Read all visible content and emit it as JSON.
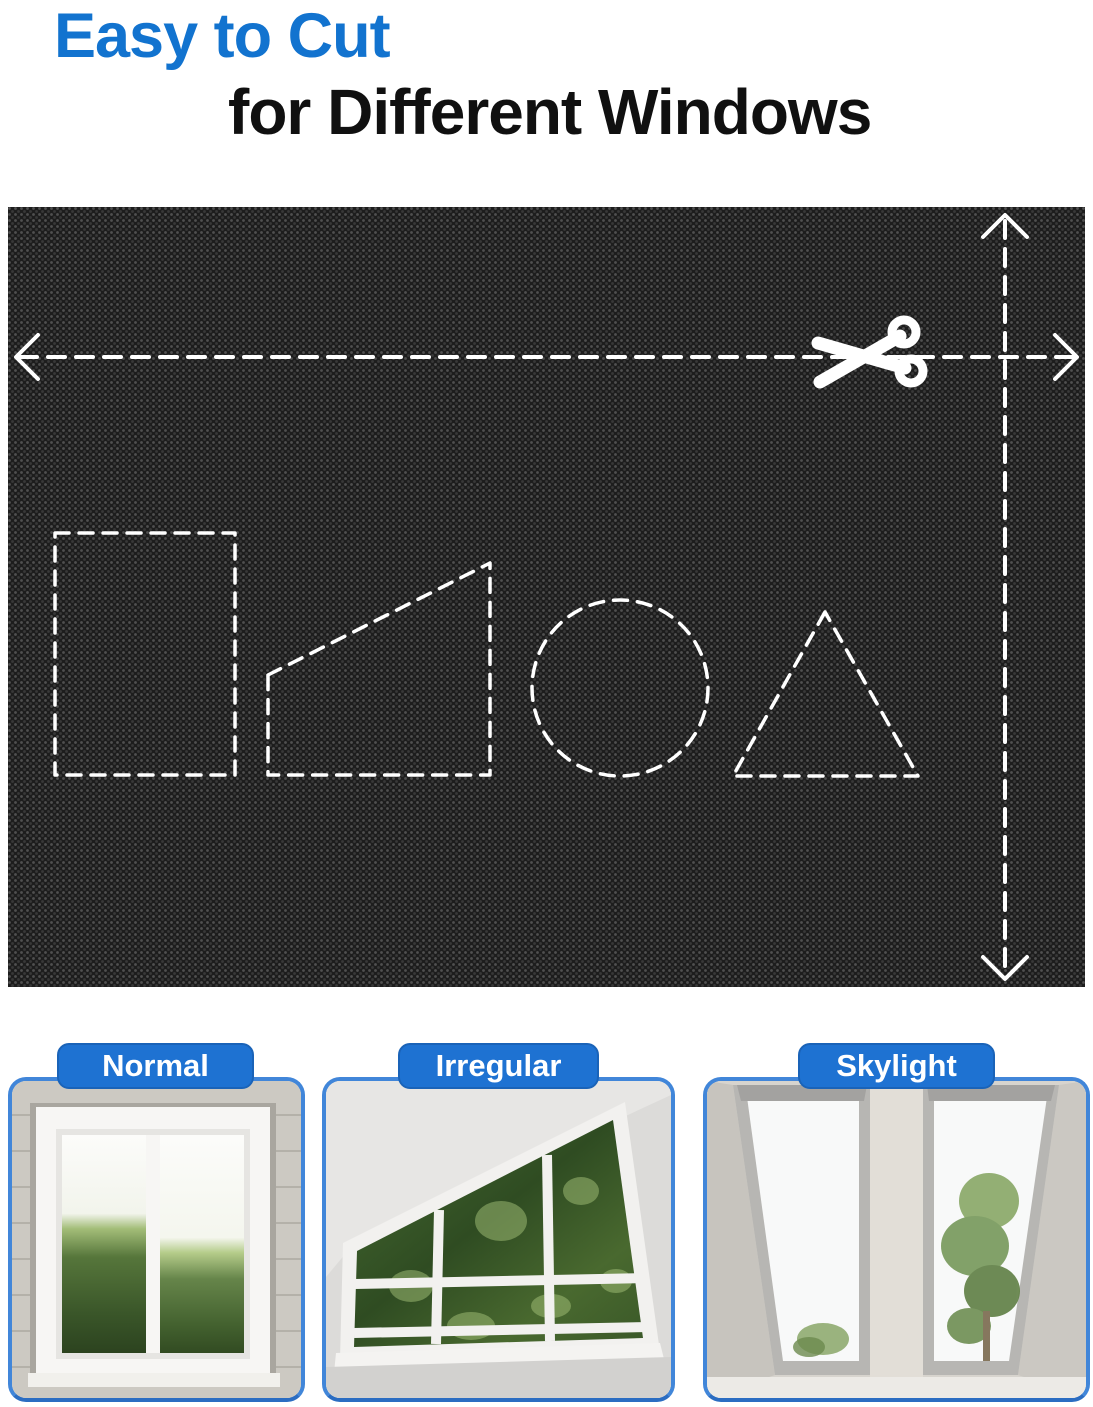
{
  "header": {
    "line1": "Easy to Cut",
    "line2": "for Different Windows"
  },
  "colors": {
    "headline_blue": "#1273cf",
    "headline_dark": "#101010",
    "tab_blue": "#1e72d2",
    "card_border_blue": "#4186d9",
    "panel_fabric_black": "#1d1d1d",
    "dash_white": "#ffffff"
  },
  "panel": {
    "icons": [
      "scissors-icon",
      "cut-arrow-horizontal",
      "cut-arrow-vertical"
    ],
    "cut_shapes": [
      "rectangle",
      "trapezoid",
      "circle",
      "triangle"
    ]
  },
  "cards": [
    {
      "label": "Normal",
      "photo": "double casement window with green hedge"
    },
    {
      "label": "Irregular",
      "photo": "slant-top attic window with tree view"
    },
    {
      "label": "Skylight",
      "photo": "two roof skylight windows with tree view"
    }
  ]
}
